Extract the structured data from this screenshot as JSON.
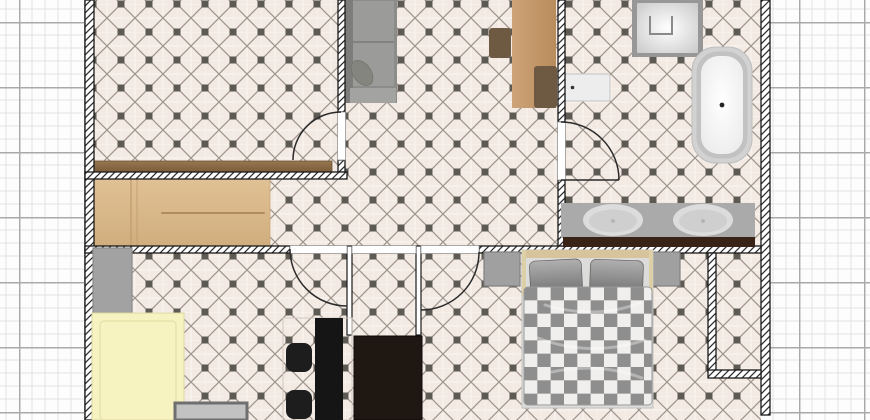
{
  "scene": {
    "type": "floor-plan-top-view"
  },
  "canvas": {
    "width": 870,
    "height": 420,
    "grid": {
      "background": "#fdfdfd",
      "minor_color": "#e2e2e2",
      "major_color": "#a9a9a9",
      "minor_step_px": 13,
      "major_step_px": 65
    },
    "floor": {
      "base_color": "#f3eae4",
      "tile_line_color": "#8d857c",
      "tile_dot_color": "#5d5953",
      "joint_color": "#fbf6f2"
    },
    "wall": {
      "fill": "#ffffff",
      "hatch_color": "#2e2e2e",
      "outline_color": "#1a1a1a"
    },
    "door": {
      "arc_color": "#2a2a2a",
      "gap_fill": "#ffffff",
      "jamb_color": "#888888"
    }
  },
  "furniture": {
    "plank_sideboard": {
      "color": "#8a6b4a",
      "edge": "#6d5236"
    },
    "sofa": {
      "base": "#8c8c8a",
      "back": "#7d7d7b",
      "cushion": "#9b9b99",
      "armrest": "#a3a3a1",
      "pillow": "#85857f"
    },
    "dining_table": {
      "color": "#c49a6d"
    },
    "dining_chairs": {
      "color": "#6e5942"
    },
    "toilet_cistern": {
      "fill": "#ededed",
      "outline": "#cccccc",
      "button": "#333333"
    },
    "shower": {
      "frame": "#979797",
      "drain": "#8a8a8a"
    },
    "bathtub": {
      "rim": "#d2d2d2",
      "inner_rim": "#c2c2c2",
      "drain": "#222222"
    },
    "vanity": {
      "counter": "#aaaaaa",
      "front_edge": "#392317",
      "sink": "#dcdcdc",
      "sink_inner": "#cfcfcf"
    },
    "kitchen_counter": {
      "color": "#d9b88d",
      "seam": "#c19a6b",
      "handle": "#b08c5e"
    },
    "fridge": {
      "color": "#a2a2a2",
      "outline": "#8b8b8b"
    },
    "yellow_table": {
      "fill": "#f6f3c1",
      "outline": "#dcd79f",
      "inner_line": "#e6dfa8"
    },
    "gray_cabinet": {
      "fill": "#c2c2c2",
      "outline": "#6f6f6f"
    },
    "bar_table": {
      "color": "#151515"
    },
    "bar_chairs": {
      "color": "#1d1d1d"
    },
    "group_outline": {
      "color": "#cfc8c0"
    },
    "wardrobe": {
      "color": "#1f1712"
    },
    "nightstands": {
      "fill": "#a0a0a0",
      "outline": "#808080"
    },
    "bed": {
      "frame": "#dcdcda",
      "frame_outline": "#c2c2c0",
      "headboard": "#d8c49c",
      "rail": "#ddcfa6",
      "pillow_dark": "#6e6e6e",
      "pillow_light": "#b0b0b0",
      "checker_dark": "#8e8e8e",
      "checker_light": "#f0efed",
      "duvet_outline": "#9a9a9a"
    }
  }
}
